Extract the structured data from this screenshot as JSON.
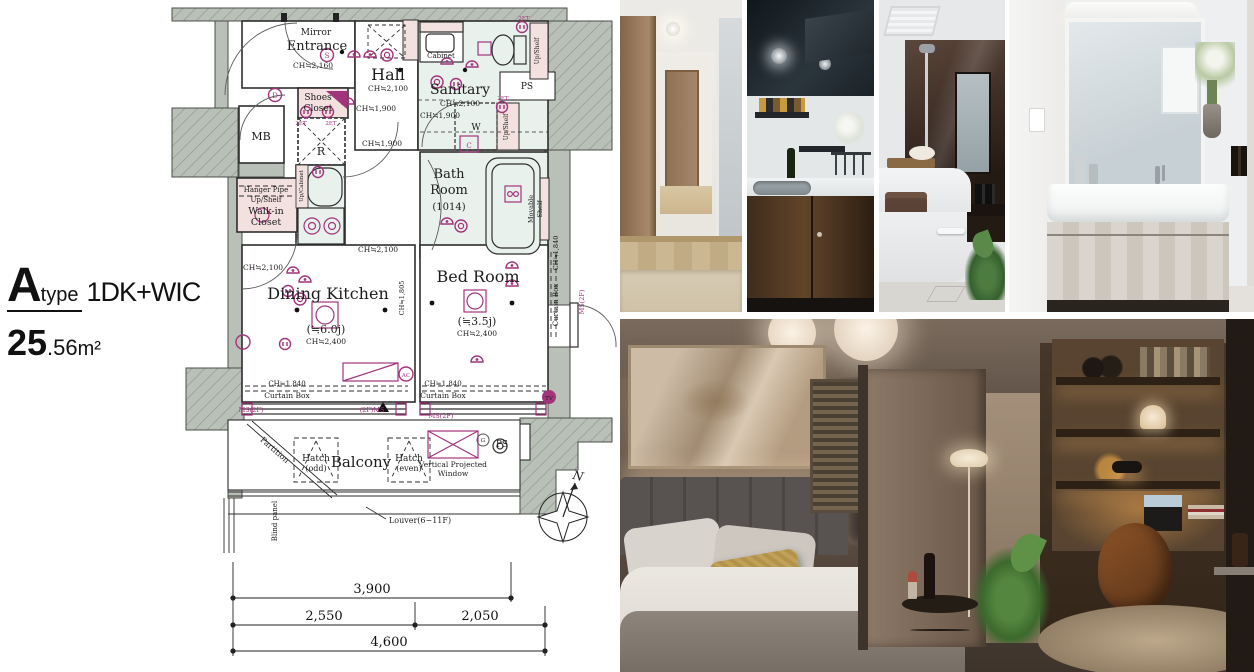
{
  "unit": {
    "type_letter": "A",
    "type_word": "type",
    "layout": "1DK+WIC",
    "area_whole": "25",
    "area_fraction": ".56",
    "area_unit": "m²"
  },
  "plan": {
    "labels": {
      "mirror": "Mirror",
      "entrance": "Entrance",
      "ch2160": "CH≒2,160",
      "hall": "Hall",
      "ch2100": "CH≒2,100",
      "ch1900": "CH≒1,900",
      "shoes1": "Shoes",
      "shoes2": "Closet",
      "r": "R",
      "et": "2ET",
      "mb": "MB",
      "sanitary": "Sanitary",
      "cabinet": "Cabinet",
      "w": "W",
      "c": "C",
      "up_shelf": "Up/Shelf",
      "ps": "PS",
      "bath1": "Bath",
      "bath2": "Room",
      "bath_size": "(1014)",
      "movable1": "Movable",
      "movable2": "Shelf",
      "hanger_pipe": "Hanger Pipe",
      "wic1": "Walk-in",
      "wic2": "Closet",
      "up_cabinet": "Up/Cabinet",
      "dk": "Dining Kitchen",
      "dk_size": "(≒6.0j)",
      "ch2400": "CH≒2,400",
      "ch1805": "CH≒1,805",
      "ch1840": "CH≒1,840",
      "curtain_box": "Curtain Box",
      "ms2f": "MS(2F)",
      "ms2f_rev": "(2F)MS",
      "bed": "Bed Room",
      "bed_size": "(≒3.5j)",
      "tv": "TV",
      "ac": "AC",
      "g": "G",
      "s": "S",
      "d": "D",
      "balcony": "Balcony",
      "hatch": "Hatch",
      "hatch_odd": "(odd)",
      "hatch_even": "(even)",
      "vpw1": "Vertical Projected",
      "vpw2": "Window",
      "louver": "Louver(6~11F)",
      "partition": "Partition",
      "blind": "Blind panel",
      "north": "N"
    },
    "dimensions": {
      "top": "3,900",
      "left": "2,550",
      "right": "2,050",
      "total": "4,600"
    },
    "colors": {
      "wall": "#b9c0b7",
      "mint": "#e9f1ec",
      "pink": "#f2e1df",
      "accent": "#a2347c"
    }
  }
}
